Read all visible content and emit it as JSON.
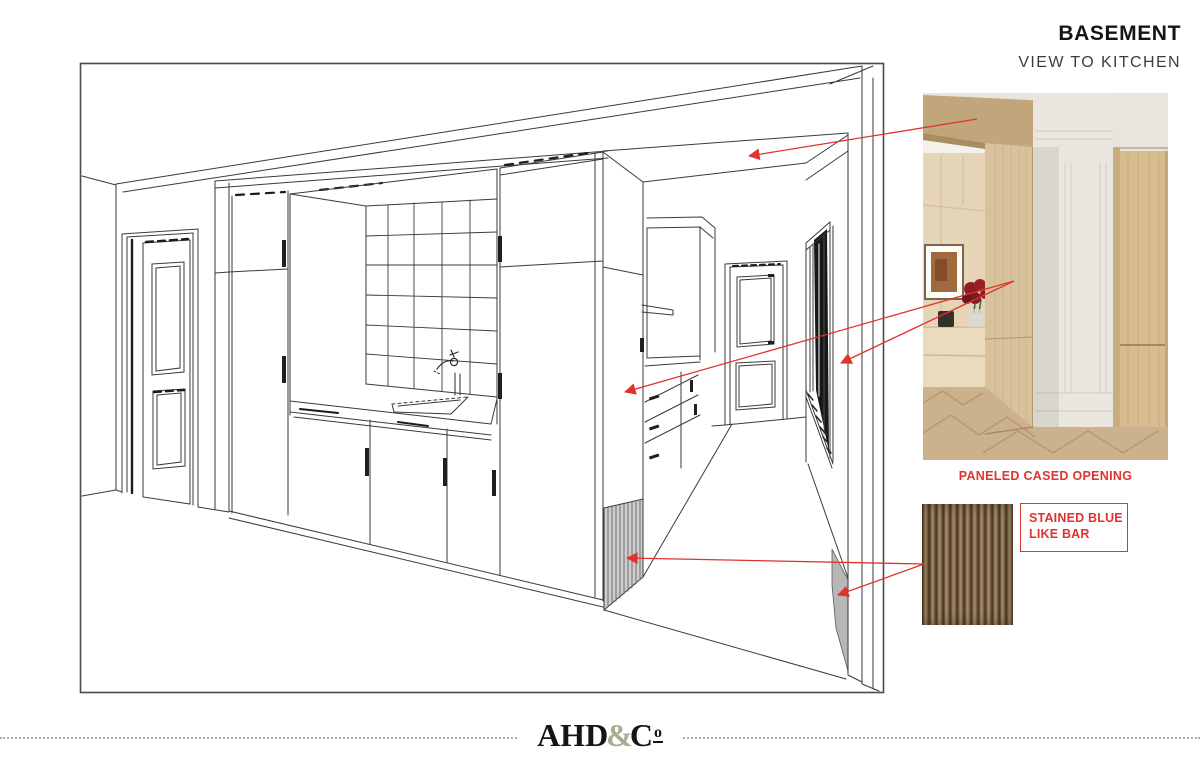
{
  "header": {
    "title": "BASEMENT",
    "subtitle": "VIEW TO KITCHEN"
  },
  "callouts": {
    "photo_label": "PANELED CASED OPENING",
    "swatch_label_line1": "STAINED BLUE",
    "swatch_label_line2": "LIKE BAR"
  },
  "footer": {
    "logo_ahd": "AHD",
    "logo_amp": "&",
    "logo_c": "C",
    "logo_o": "o"
  },
  "colors": {
    "accent_red": "#e0332d",
    "drawing_line": "#3a3a3a",
    "logo_ampersand": "#a9ac90",
    "swatch_wood_dark": "#4a3826",
    "swatch_wood_light": "#ab9170"
  }
}
